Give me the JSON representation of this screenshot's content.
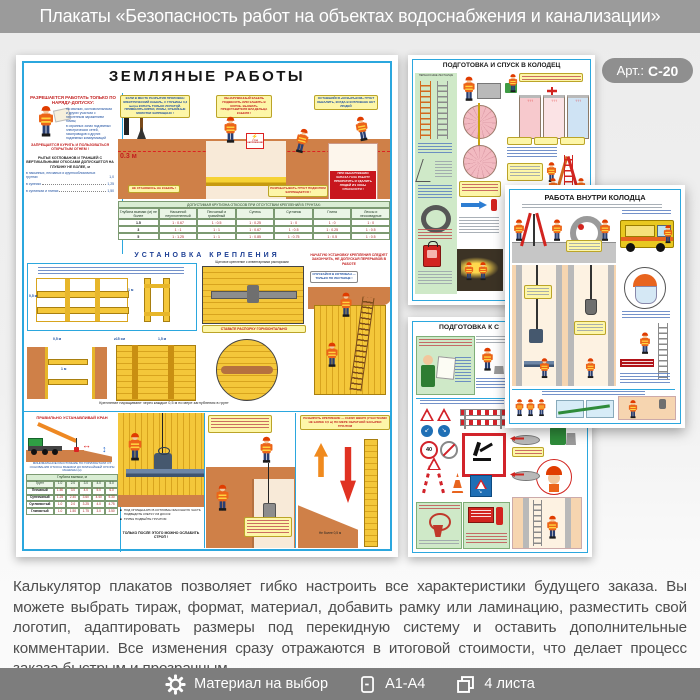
{
  "header": {
    "title": "Плакаты «Безопасность работ на объектах водоснабжения и канализации»"
  },
  "badge": {
    "label": "Арт.:",
    "code": "С-20"
  },
  "description": "Калькулятор плакатов позволяет гибко настроить все характеристики будущего заказа. Вы можете выбрать тираж, формат, материал, добавить рамку или ламинацию, разместить свой логотип, адаптировать размеры под перекидную систему и оставить дополнительные комментарии. Все изменения сразу отражаются в итоговой стоимости, что делает процесс заказа быстрым и прозрачным",
  "footer": {
    "items": [
      {
        "icon": "gear-icon",
        "label": "Материал на выбор"
      },
      {
        "icon": "document-icon",
        "label": "А1-А4"
      },
      {
        "icon": "sheets-icon",
        "label": "4 листа"
      }
    ]
  },
  "posters": {
    "earthworks": {
      "title": "ЗЕМЛЯНЫЕ РАБОТЫ",
      "permit_heading": "РАЗРЕШАЕТСЯ РАБОТАТЬ ТОЛЬКО ПО НАРЯДУ-ДОПУСКУ:",
      "permit_item1": "на свалках, скотомогильниках и других участках с патогенным заражением почвы;",
      "permit_item2": "в охранных зонах подземных электрических сетей, газопроводов и других подземных коммуникаций",
      "no_fire": "ЗАПРЕЩАЕТСЯ КУРИТЬ И ПОЛЬЗОВАТЬСЯ ОТКРЫТЫМ ОГНЕМ !",
      "vertical_note": "РЫТЬЕ КОТЛОВАНОВ И ТРАНШЕЙ С ВЕРТИКАЛЬНЫМИ ОТКОСАМИ ДОПУСКАЕТСЯ НА ГЛУБИНУ НЕ БОЛЕЕ, м",
      "depth_items": [
        {
          "label": "в насыпных, песчаных и крупнообломочных грунтах",
          "value": "1,0"
        },
        {
          "label": "в супесях",
          "value": "1,25"
        },
        {
          "label": "в суглинках и глинах",
          "value": "1,50"
        }
      ],
      "depth_03": "0.3 м",
      "bubbles": {
        "cable_dig": "ЕСЛИ В МЕСТЕ РАЗРЫТИЯ ПРОЛОЖЕН ЭЛЕКТРИЧЕСКИЙ КАБЕЛЬ, С ГЛУБИНЫ 0,3 метра КОПАТЬ ТОЛЬКО ЛОПАТОЙ. ПРИМЕНЯТЬ КИРКИ, ЛОМЫ, ОТБОЙНЫЕ МОЛОТКИ ЗАПРЕЩЕНО !",
        "cable_box": "ОБНАРУЖЕННЫЙ КАБЕЛЬ ПОДВЕСИТЬ ИЛИ ЗАШИТЬ В КОРОБ. ВЫЗВАТЬ ПРЕДСТАВИТЕЛЯ ВЛАДЕЛЬЦА КАБЕЛЯ !",
        "cornice": "ОСТАВШИЙСЯ «КОЗЫРЬКОМ» ГРУНТ ОБВАЛИТЬ, КОГДА В КОТЛОВАНЕ НЕТ ЛЮДЕЙ",
        "no_stand_cable": "НЕ СТАНОВИСЬ НА КАБЕЛЬ !",
        "no_undercut": "РАЗРАБАТЫВАТЬ ГРУНТ ПОДКОПОМ ЗАПРЕЩАЕТСЯ !",
        "gas_warning": "ПРИ ОБНАРУЖЕНИИ ЗАПАХА ГАЗА РАБОТУ ПРЕКРАТИТЬ И УДАЛИТЬ ЛЮДЕЙ ИЗ ЗОНЫ ОПАСНОСТИ !",
        "stop_voltage": "СТОЙ НАПРЯЖЕНИЕ"
      },
      "slope_table": {
        "caption": "ДОПУСТИМАЯ КРУТИЗНА ОТКОСОВ ПРИ ОТСУТСТВИИ КРЕПЛЕНИЙ В ГРУНТАХ:",
        "col_headers": [
          "Глубина выемки (м) не более",
          "Насыпной неуплотненный",
          "Песчаный и гравийный",
          "Супесь",
          "Суглинок",
          "Глина",
          "Лессы и лессовидные"
        ],
        "rows": [
          [
            "1.5",
            "1 : 0.67",
            "1 : 0.5",
            "1 : 0.25",
            "1 : 0",
            "1 : 0",
            "1 : 0"
          ],
          [
            "3",
            "1 : 1",
            "1 : 1",
            "1 : 0.67",
            "1 : 0.5",
            "1 : 0.25",
            "1 : 0.5"
          ],
          [
            "5",
            "1 : 1.25",
            "1 : 1",
            "1 : 0.85",
            "1 : 0.75",
            "1 : 0.5",
            "1 : 0.5"
          ]
        ]
      },
      "bracing": {
        "heading": "УСТАНОВКА КРЕПЛЕНИЯ",
        "shield_caption": "Щитовое крепление с инвентарными распорками",
        "warning": "НАЧАТУЮ УСТАНОВКУ КРЕПЛЕНИЯ СЛЕДУЕТ ЗАКОНЧИТЬ, НЕ ДОПУСКАЯ ПЕРЕРЫВОВ В РАБОТЕ",
        "ladder_bubble": "СПУСКАЙСЯ В КОТЛОВАН — ТОЛЬКО ПО ЛЕСТНИЦЕ !",
        "spacer_bubble": "СТАВЬТЕ РАСПОРКУ ГОРИЗОНТАЛЬНО",
        "note": "Крепление наращивают через каждые 0,5 м по мере заглубления в грунт",
        "dim_05": "0,5 м",
        "dim_1": "1 м",
        "dim_15": "1,5 м",
        "dim_plank": "≥15 см"
      },
      "crane": {
        "heading": "ПРАВИЛЬНО УСТАНАВЛИВАЙ КРАН",
        "note": "МИНИМАЛЬНОЕ РАССТОЯНИЕ ПО ГОРИЗОНТАЛИ ОТ ОСНОВАНИЯ ОТКОСА ВЫЕМКИ ДО БЛИЖАЙШЕЙ ОПОРЫ МАШИНЫ (м)",
        "table": {
          "caption": "Глубина выемки, м",
          "col_headers": [
            "Грунт",
            "1.0",
            "2.0",
            "3.0",
            "4.0",
            "5.0"
          ],
          "rows": [
            [
              "Песчаный",
              "1.50",
              "3.0",
              "4.0",
              "5.0",
              "6.0"
            ],
            [
              "Супесчаный",
              "1.25",
              "2.40",
              "3.60",
              "4.40",
              "5.30"
            ],
            [
              "Суглинистый",
              "1.0",
              "2.0",
              "3.25",
              "4.0",
              "4.75"
            ],
            [
              "Глинистый",
              "1.0",
              "1.50",
              "1.75",
              "3.0",
              "3.50"
            ]
          ]
        }
      },
      "valve": {
        "b1": "ПОД ОПУЩЕННУЮ В КОТЛОВАН ФАСОННУЮ ЧАСТЬ ПОДВЕДИТЕ КЛЕТКУ ИЗ ДОСОК",
        "b2": "ТРУБЫ ПОДБЕЙТЕ ГРУНТОМ",
        "note": "ТОЛЬКО ПОСЛЕ ЭТОГО МОЖНО ОСЛАБИТЬ СТРОП !"
      },
      "dismantle": {
        "bubble": "РАЗБИРАТЬ КРЕПЛЕНИЕ — СНИЗУ ВВЕРХ (УЧАСТКАМИ НЕ БОЛЕЕ 0,5 м) ПО МЕРЕ ОБРАТНОЙ ЗАСЫПКИ ГРУНТОМ",
        "dim": "Не более 0,5 м"
      }
    },
    "descent": {
      "title": "ПОДГОТОВКА И СПУСК В КОЛОДЕЦ",
      "ladders_caption": "ПЕРЕНОСНЫЕ ЛЕСТНИЦЫ"
    },
    "inside_well": {
      "title": "РАБОТА ВНУТРИ КОЛОДЦА"
    },
    "preparation": {
      "title_visible": "ПОДГОТОВКА К С",
      "speed_sign": "40"
    }
  },
  "colors": {
    "header_bar": "#9b9b9b",
    "footer_bar": "#7d7d7d",
    "badge": "#8f8f8f",
    "poster_frame_blue": "#2ba7de",
    "accent_red": "#c8252b",
    "accent_yellow": "#f5c63a",
    "soil_orange": "#cf8048",
    "mint_green": "#cfe9c8",
    "background": "#f0f0f0"
  }
}
